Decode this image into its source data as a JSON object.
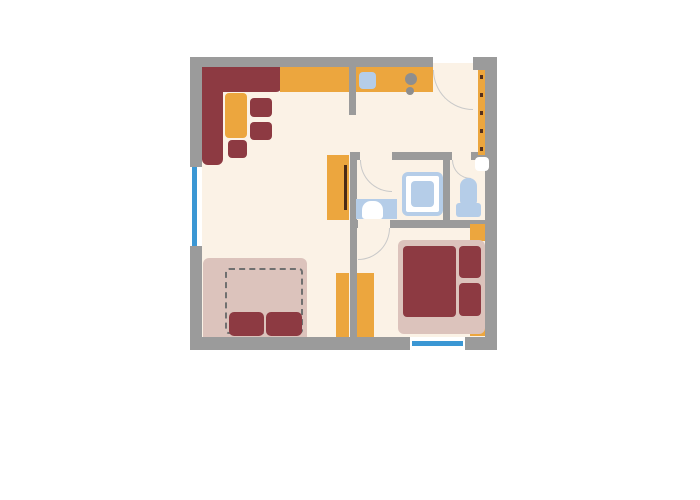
{
  "title": "apartment-floor-plan",
  "colors": {
    "page": "#ffffff",
    "wall": "#9b9b9b",
    "floor": "#fbf2e6",
    "orange": "#eca63e",
    "maroon": "#8d3a42",
    "pink": "#dcc3bc",
    "fixture": "#b5cde8",
    "window": "#3b97d4",
    "white": "#ffffff",
    "dash": "#707070",
    "hook": "#55301c",
    "arc": "#c9c9c9",
    "burner": "#8e8e8e",
    "tvline": "#4a2a16"
  },
  "rooms": [
    "living-dining-area",
    "kitchen",
    "entrance-hall",
    "bathroom",
    "wc",
    "bedroom"
  ],
  "features": {
    "windows": 2,
    "door_arcs": [
      "entrance-door",
      "bathroom-door",
      "wc-door",
      "bedroom-door"
    ],
    "coat_hooks": 5
  }
}
